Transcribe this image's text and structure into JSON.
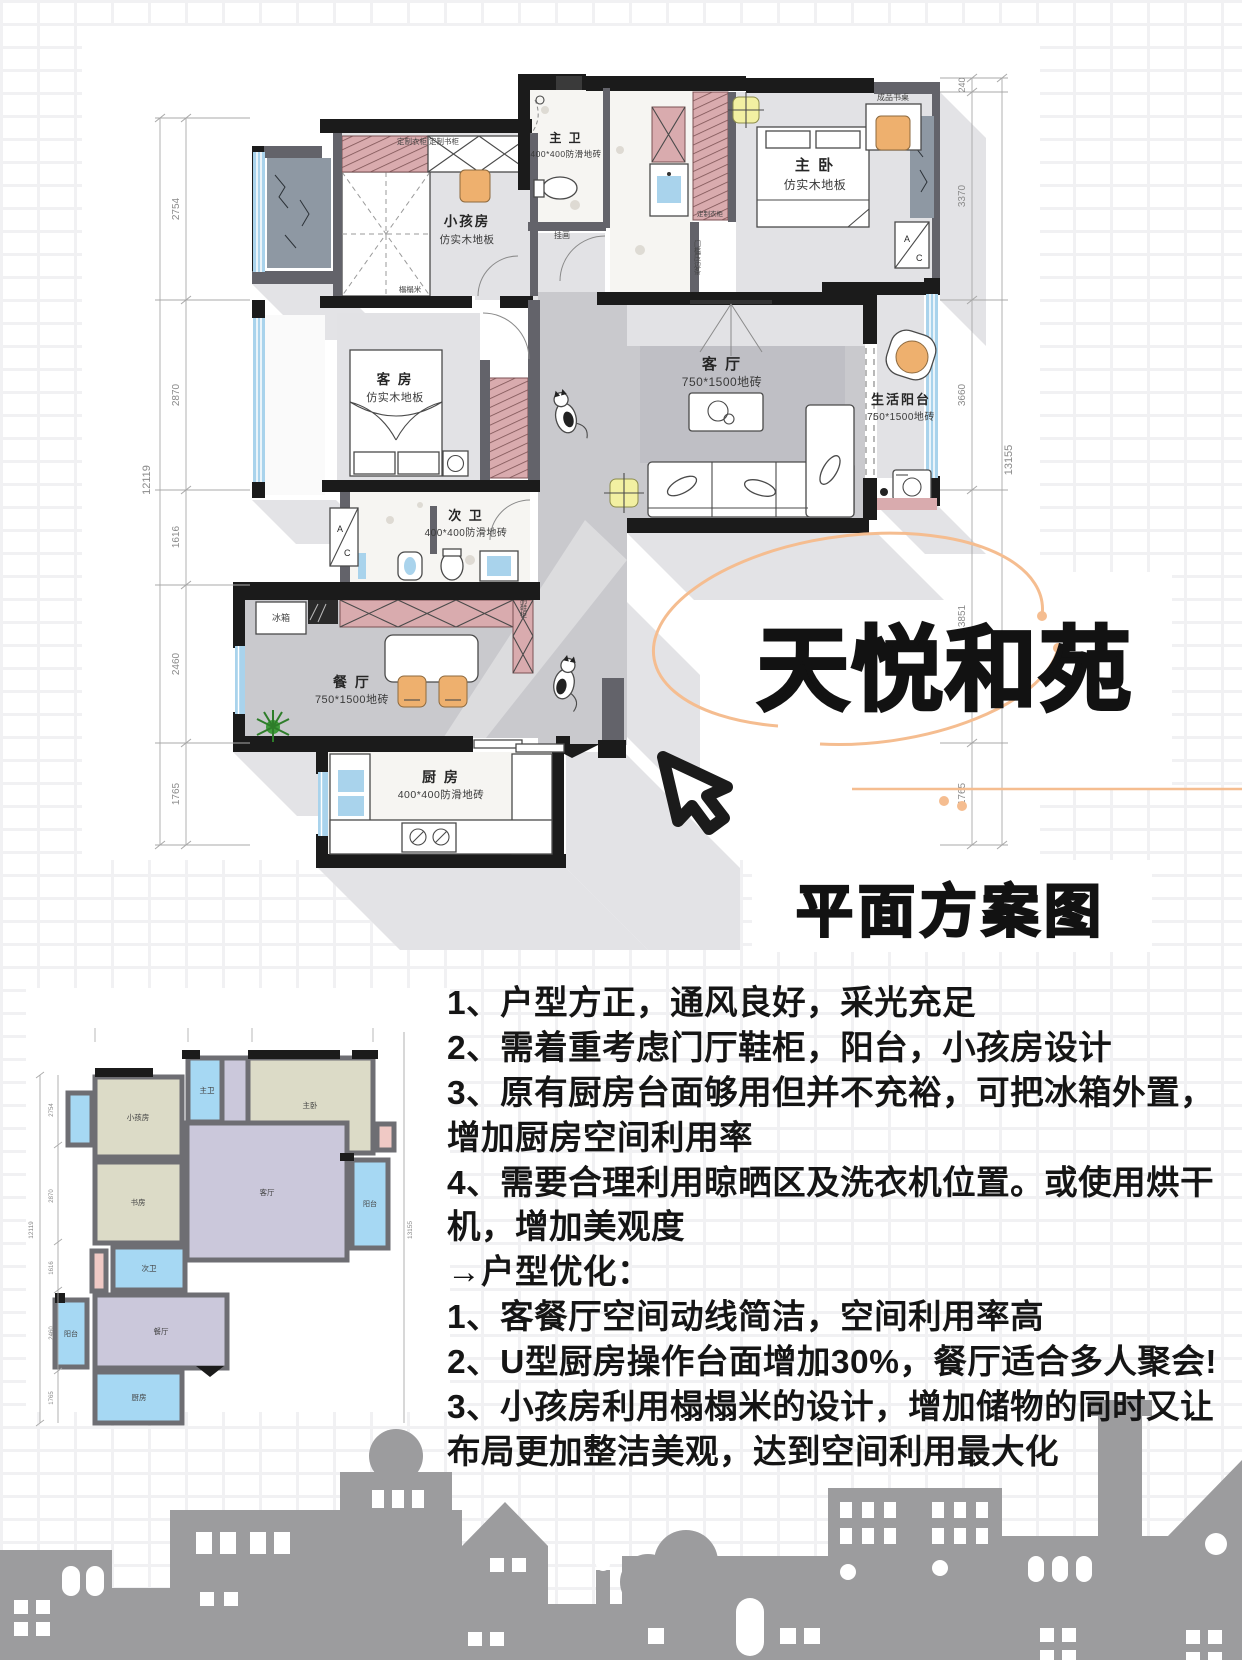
{
  "page": {
    "title": "天悦和苑",
    "subtitle": "平面方案图"
  },
  "main_plan": {
    "rooms": {
      "kids": {
        "name": "小孩房",
        "floor": "仿实木地板"
      },
      "master_bath": {
        "name": "主 卫",
        "floor": "400*400防滑地砖"
      },
      "master": {
        "name": "主 卧",
        "floor": "仿实木地板"
      },
      "guest": {
        "name": "客 房",
        "floor": "仿实木地板"
      },
      "living": {
        "name": "客 厅",
        "floor": "750*1500地砖"
      },
      "life_balcony": {
        "name": "生活阳台",
        "floor": "750*1500地砖"
      },
      "second_bath": {
        "name": "次 卫",
        "floor": "400*400防滑地砖"
      },
      "dining": {
        "name": "餐 厅",
        "floor": "750*1500地砖"
      },
      "kitchen": {
        "name": "厨 房",
        "floor": "400*400防滑地砖"
      }
    },
    "annotations": {
      "desk": "成品书桌",
      "wardrobe": "定制衣柜",
      "bookcase": "定制书柜",
      "closet": "定制衣柜",
      "shoe_cabinet": "定制鞋柜",
      "fridge": "冰箱",
      "tatami": "榻榻米",
      "threshold": "门槛压边条",
      "picture": "挂画",
      "ac_top": "A",
      "ac_bottom": "C"
    },
    "dims_left": {
      "total": "12119",
      "segments": [
        "2754",
        "2870",
        "1616",
        "2460",
        "1765"
      ]
    },
    "dims_right": {
      "total": "13155",
      "segments": [
        "240",
        "3370",
        "3660",
        "3851",
        "1765"
      ]
    }
  },
  "small_plan": {
    "rooms": [
      "小孩房",
      "主卫",
      "主卧",
      "书房",
      "客厅",
      "阳台",
      "次卫",
      "阳台",
      "餐厅",
      "厨房"
    ],
    "dims": {
      "left_total": "12119",
      "right_total": "13155"
    }
  },
  "notes": {
    "lines": [
      "1、户型方正，通风良好，采光充足",
      "2、需着重考虑门厅鞋柜，阳台，小孩房设计",
      "3、原有厨房台面够用但并不充裕，可把冰箱外置，增加厨房空间利用率",
      "4、需要合理利用晾晒区及洗衣机位置。或使用烘干机，增加美观度",
      "→户型优化：",
      "1、客餐厅空间动线简洁，空间利用率高",
      "2、U型厨房操作台面增加30%，餐厅适合多人聚会!",
      "3、小孩房利用榻榻米的设计，增加储物的同时又让布局更加整洁美观，达到空间利用最大化"
    ]
  },
  "colors": {
    "grid_line": "#f1f1f3",
    "wall_black": "#1b1b1b",
    "wall_gray": "#63636a",
    "floor_gray": "#c9c9cd",
    "floor_light": "#e2e2e5",
    "floor_rug": "#bfbfc5",
    "terrazzo": "#f6f5f2",
    "window_blue": "#a9d3ec",
    "cabinet_pink": "#d9abae",
    "stone_gray": "#8e98a3",
    "accent_orange": "#eeb06e",
    "swirl_orange": "#f5bd90",
    "light_yellow": "#f2f0a2",
    "shadow": "#e3e3e6",
    "skyline_gray": "#9c9c9e",
    "sp_beige": "#dcdbc7",
    "sp_blue": "#a6d8f3",
    "sp_lavender": "#cbc8db",
    "sp_pink": "#f0c9c5",
    "sp_wall": "#6e6e73"
  }
}
